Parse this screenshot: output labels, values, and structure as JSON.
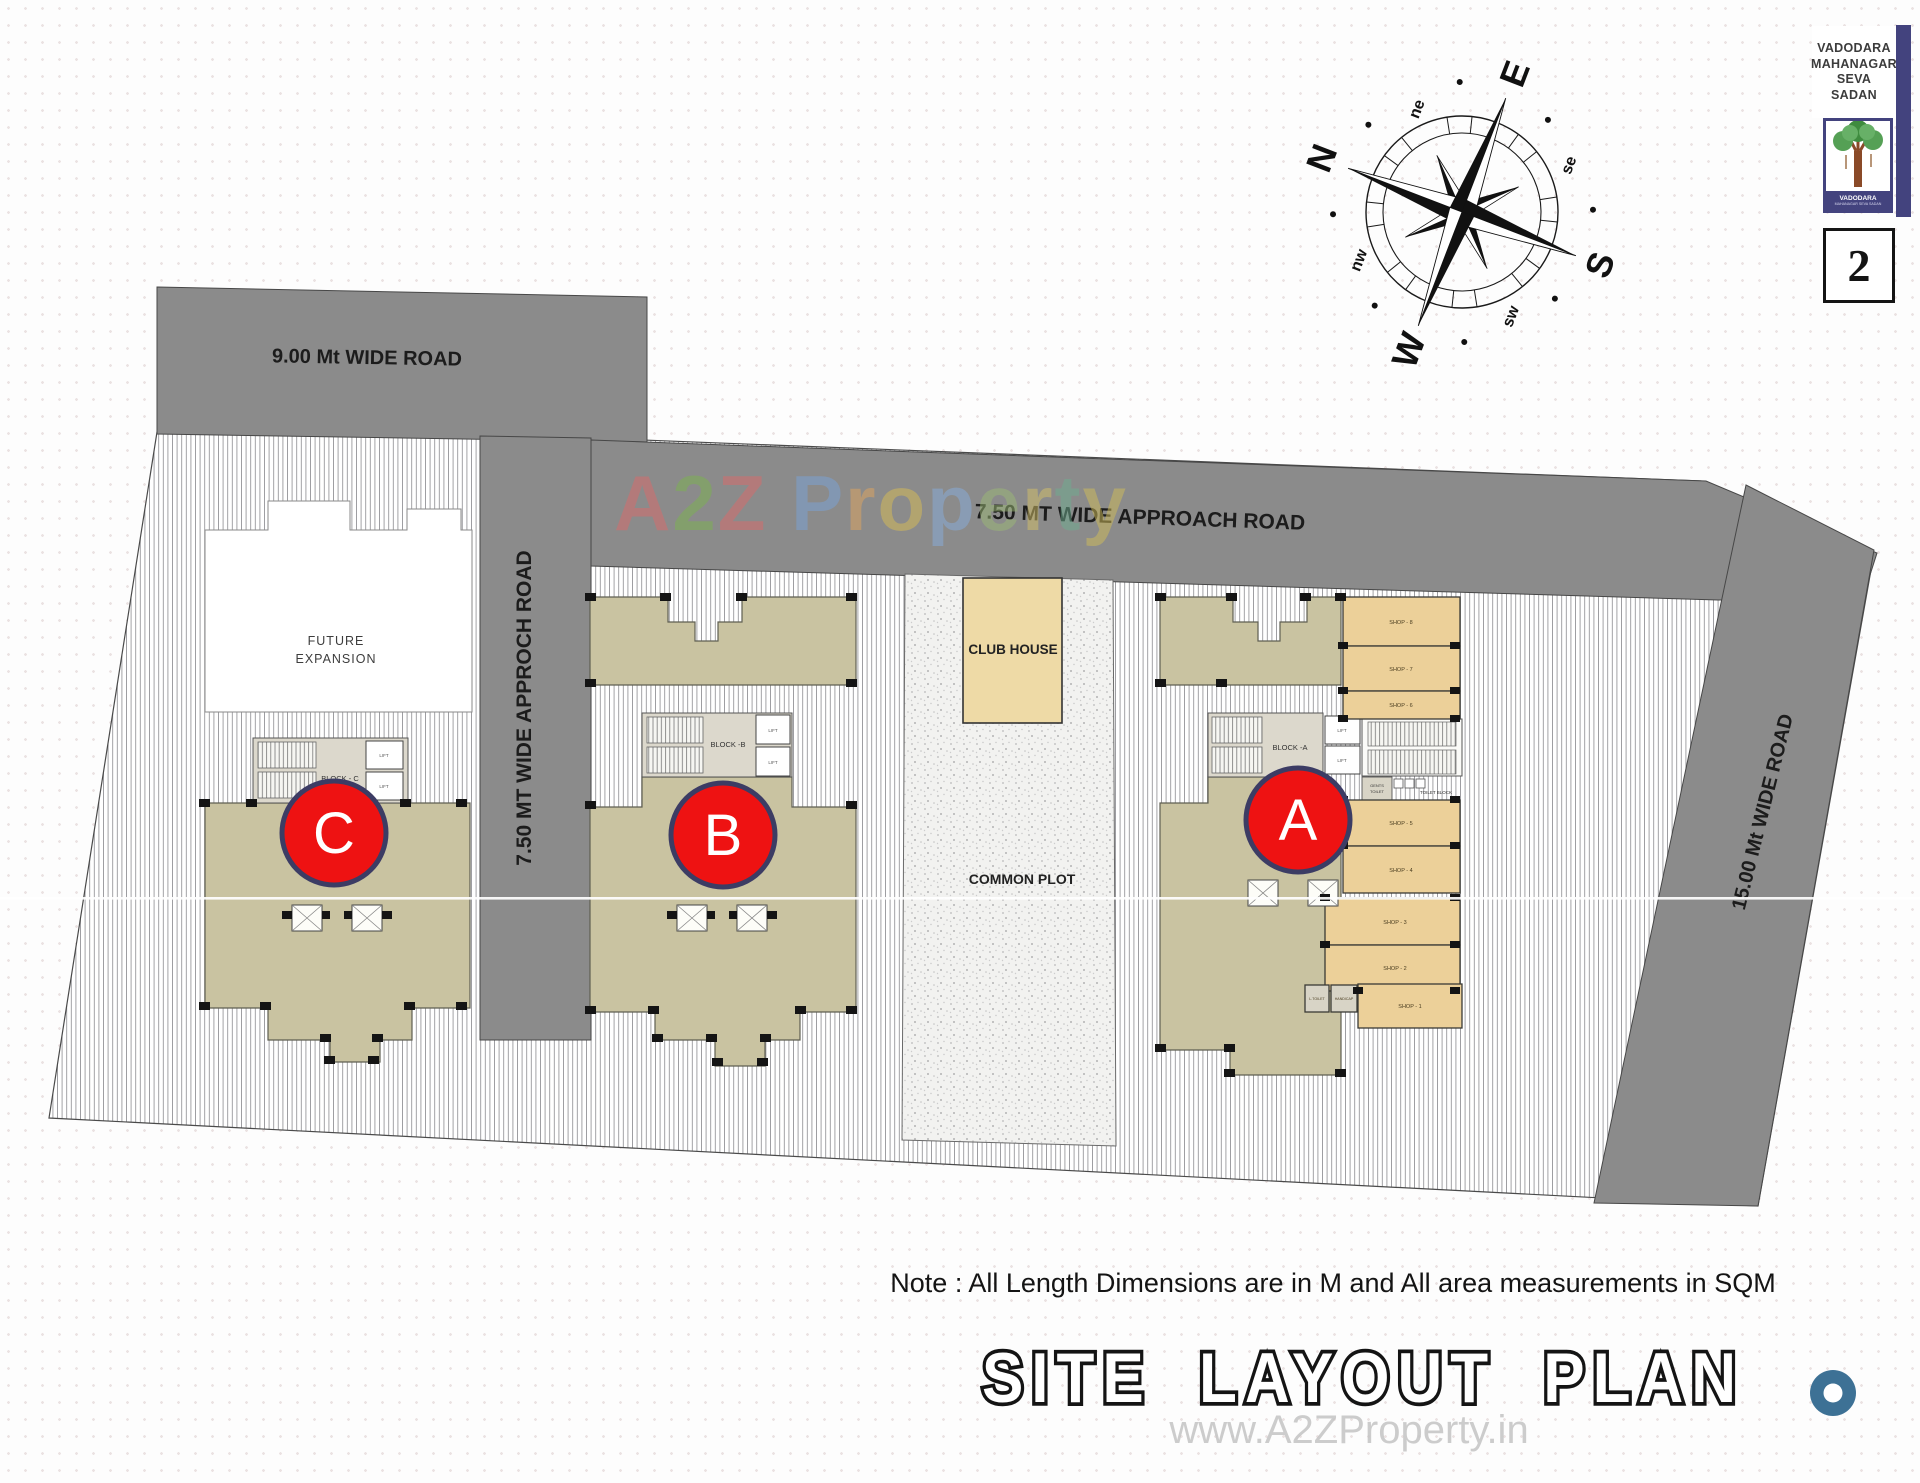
{
  "colors": {
    "road_gray": "#8b8b8b",
    "building_tan": "#c9c3a1",
    "core_gray": "#dcd8cc",
    "shop_tan": "#ecd099",
    "club_house_tan": "#eedaa6",
    "badge_red": "#ee1212",
    "badge_border": "#3c3c64",
    "logo_blue": "#43437e",
    "donut_blue": "#3d7195"
  },
  "roads": {
    "top_left_label": "9.00 Mt WIDE ROAD",
    "approach_horizontal_label": "7.50 MT WIDE APPROACH ROAD",
    "approach_vertical_label": "7.50 MT WIDE APPROCH ROAD",
    "right_label": "15.00 Mt WIDE ROAD"
  },
  "site": {
    "future_expansion_line1": "FUTURE",
    "future_expansion_line2": "EXPANSION",
    "club_house_label": "CLUB HOUSE",
    "common_plot_label": "COMMON PLOT"
  },
  "blocks": {
    "lift_label": "LIFT",
    "a": {
      "label": "BLOCK -A",
      "badge": "A"
    },
    "b": {
      "label": "BLOCK -B",
      "badge": "B"
    },
    "c": {
      "label": "BLOCK - C",
      "badge": "C"
    }
  },
  "shops": {
    "upper": [
      "SHOP - 8",
      "SHOP - 7",
      "SHOP - 6"
    ],
    "lower": [
      "SHOP - 5",
      "SHOP - 4",
      "SHOP - 3",
      "SHOP - 2",
      "SHOP - 1"
    ],
    "gents_toilet_line1": "GENTS",
    "gents_toilet_line2": "TOILET",
    "toilet_block": "TOILET BLOCK",
    "l_toilet": "L.TOILET",
    "handicap": "HANDICAP"
  },
  "compass": {
    "n": "N",
    "e": "E",
    "s": "S",
    "w": "W",
    "ne": "ne",
    "se": "se",
    "sw": "sw",
    "nw": "nw"
  },
  "corner": {
    "authority_lines": [
      "VADODARA",
      "MAHANAGAR",
      "SEVA",
      "SADAN"
    ],
    "seal_caption_line1": "VADODARA",
    "seal_caption_line2": "MAHANAGAR SEVA SADAN",
    "sheet_number": "2"
  },
  "watermarks": {
    "center_letters": [
      {
        "ch": "A",
        "color": "#dc6a6a"
      },
      {
        "ch": "2",
        "color": "#7cb34f"
      },
      {
        "ch": "Z",
        "color": "#dc6a6a"
      },
      {
        "ch": " ",
        "color": "#888888"
      },
      {
        "ch": "P",
        "color": "#7aa3d9"
      },
      {
        "ch": "r",
        "color": "#e2a55f"
      },
      {
        "ch": "o",
        "color": "#d9bd55"
      },
      {
        "ch": "p",
        "color": "#88aede"
      },
      {
        "ch": "e",
        "color": "#9cba77"
      },
      {
        "ch": "r",
        "color": "#d6c268"
      },
      {
        "ch": "t",
        "color": "#6fae90"
      },
      {
        "ch": "y",
        "color": "#d2be59"
      }
    ],
    "bottom": "www.A2ZProperty.in"
  },
  "note": "Note : All Length Dimensions are in M and All area measurements in SQM",
  "title": "SITE LAYOUT PLAN"
}
